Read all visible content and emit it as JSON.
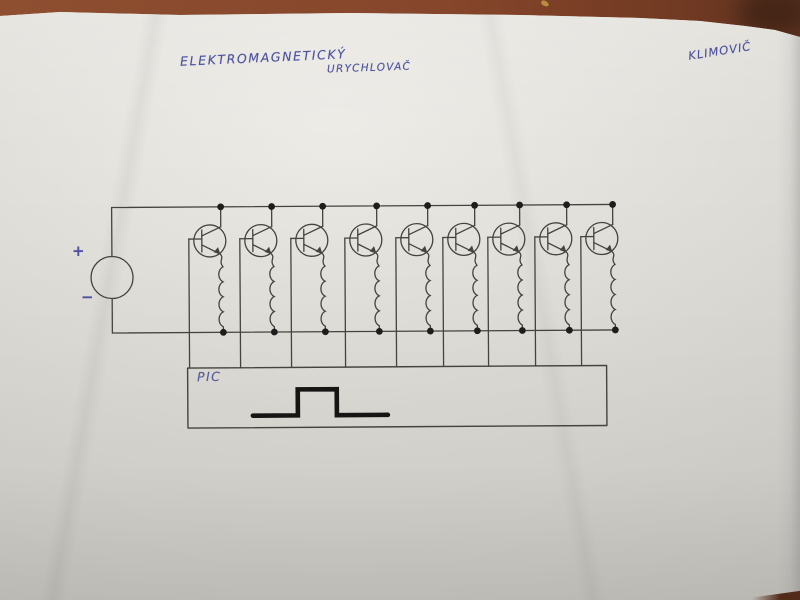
{
  "photo": {
    "table_color": "#84452a",
    "paper_color": "#dcdad4",
    "ink_color": "#4d529f",
    "pencil_color": "#45433f"
  },
  "annotations": {
    "title_line1": "ELEKTROMAGNETICKÝ",
    "title_line2": "URYCHLOVAČ",
    "author": "KLIMOVIČ"
  },
  "diagram": {
    "type": "hand-drawn circuit schematic",
    "source_plus": "+",
    "source_minus": "−",
    "controller_label": "PIC",
    "stage_count": 9,
    "stage_centers_x": [
      210,
      261,
      312,
      366,
      417,
      464,
      509,
      556,
      602
    ],
    "stage_center_y": 240,
    "top_rail_y": 206,
    "bottom_rail_y": 331.5,
    "pic_box": {
      "x": 187,
      "y": 367,
      "width": 419,
      "height": 60
    },
    "pulse_points": "252,415 297,415 297,389 336,389 336,415 387,415"
  }
}
